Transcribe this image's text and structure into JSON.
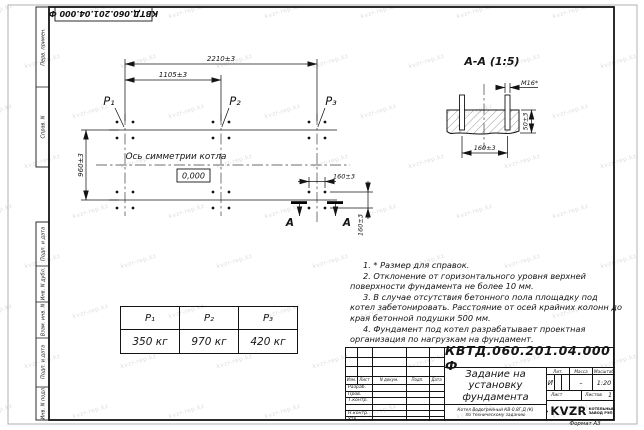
{
  "page": {
    "doc_number_top": "КВТД.060.201.04.000  Ф"
  },
  "watermark": {
    "text": "kvzr-rep.kz"
  },
  "side_stamps": {
    "perv": "Перв. примен.",
    "sprav": "Справ. N",
    "podp1": "Подп. и дата",
    "inv_dubl": "Инв. N дубл.",
    "vzam": "Взам. инв. N",
    "podp2": "Подп. и дата",
    "inv_podl": "Инв. N подл."
  },
  "plan": {
    "p1": "P₁",
    "p2": "P₂",
    "p3": "P₃",
    "dim_total": "2210±3",
    "dim_half": "1105±3",
    "dim_height": "960±3",
    "dim_bolt_h": "160±3",
    "dim_bolt_v": "160±3",
    "axis_label": "Ось симметрии котла",
    "elevation": "0,000",
    "section_letter_left": "А",
    "section_letter_right": "А"
  },
  "section": {
    "title": "А-А (1:5)",
    "bolt": "М16*",
    "dim_width": "160±3",
    "dim_height": "50±3"
  },
  "notes": [
    "1. * Размер для справок.",
    "2. Отклонение от горизонтального уровня верхней поверхности фундамента не более 10 мм.",
    "3. В случае отсутствия бетонного пола площадку под котел забетонировать. Расстояние от осей крайних колонн до края бетонной подушки 500 мм.",
    "4. Фундамент под котел разрабатывает проектная организация по нагрузкам на фундамент."
  ],
  "load_table": {
    "headers": [
      "P₁",
      "P₂",
      "P₃"
    ],
    "values": [
      "350 кг",
      "970 кг",
      "420 кг"
    ]
  },
  "title_block": {
    "doc_number": "КВТД.060.201.04.000  Ф",
    "col_izm": "Изм.",
    "col_list": "Лист",
    "col_ndoc": "N докум.",
    "col_podp": "Подп.",
    "col_data": "Дата",
    "row_razrab": "Разраб.",
    "row_prov": "Пров.",
    "row_tkontr": "Т.контр.",
    "row_nkontr": "Н.контр.",
    "row_utv": "Утв.",
    "title_line1": "Задание на",
    "title_line2": "установку",
    "title_line3": "фундамента",
    "lit": "Лит.",
    "mass": "Масса",
    "scale": "Масштаб",
    "lit_value": "И",
    "mass_value": "–",
    "scale_value": "1:20",
    "sheet": "Лист",
    "sheets": "Листов",
    "sheets_value": "1",
    "product": "Котел Водогрейный КВ-0,8Г,Д (К) по техническому заданию",
    "logo": "KVZR",
    "company_line1": "КОТЕЛЬНЫЙ",
    "company_line2": "ЗАВОД РЭП",
    "format_note": "Формат А3"
  }
}
